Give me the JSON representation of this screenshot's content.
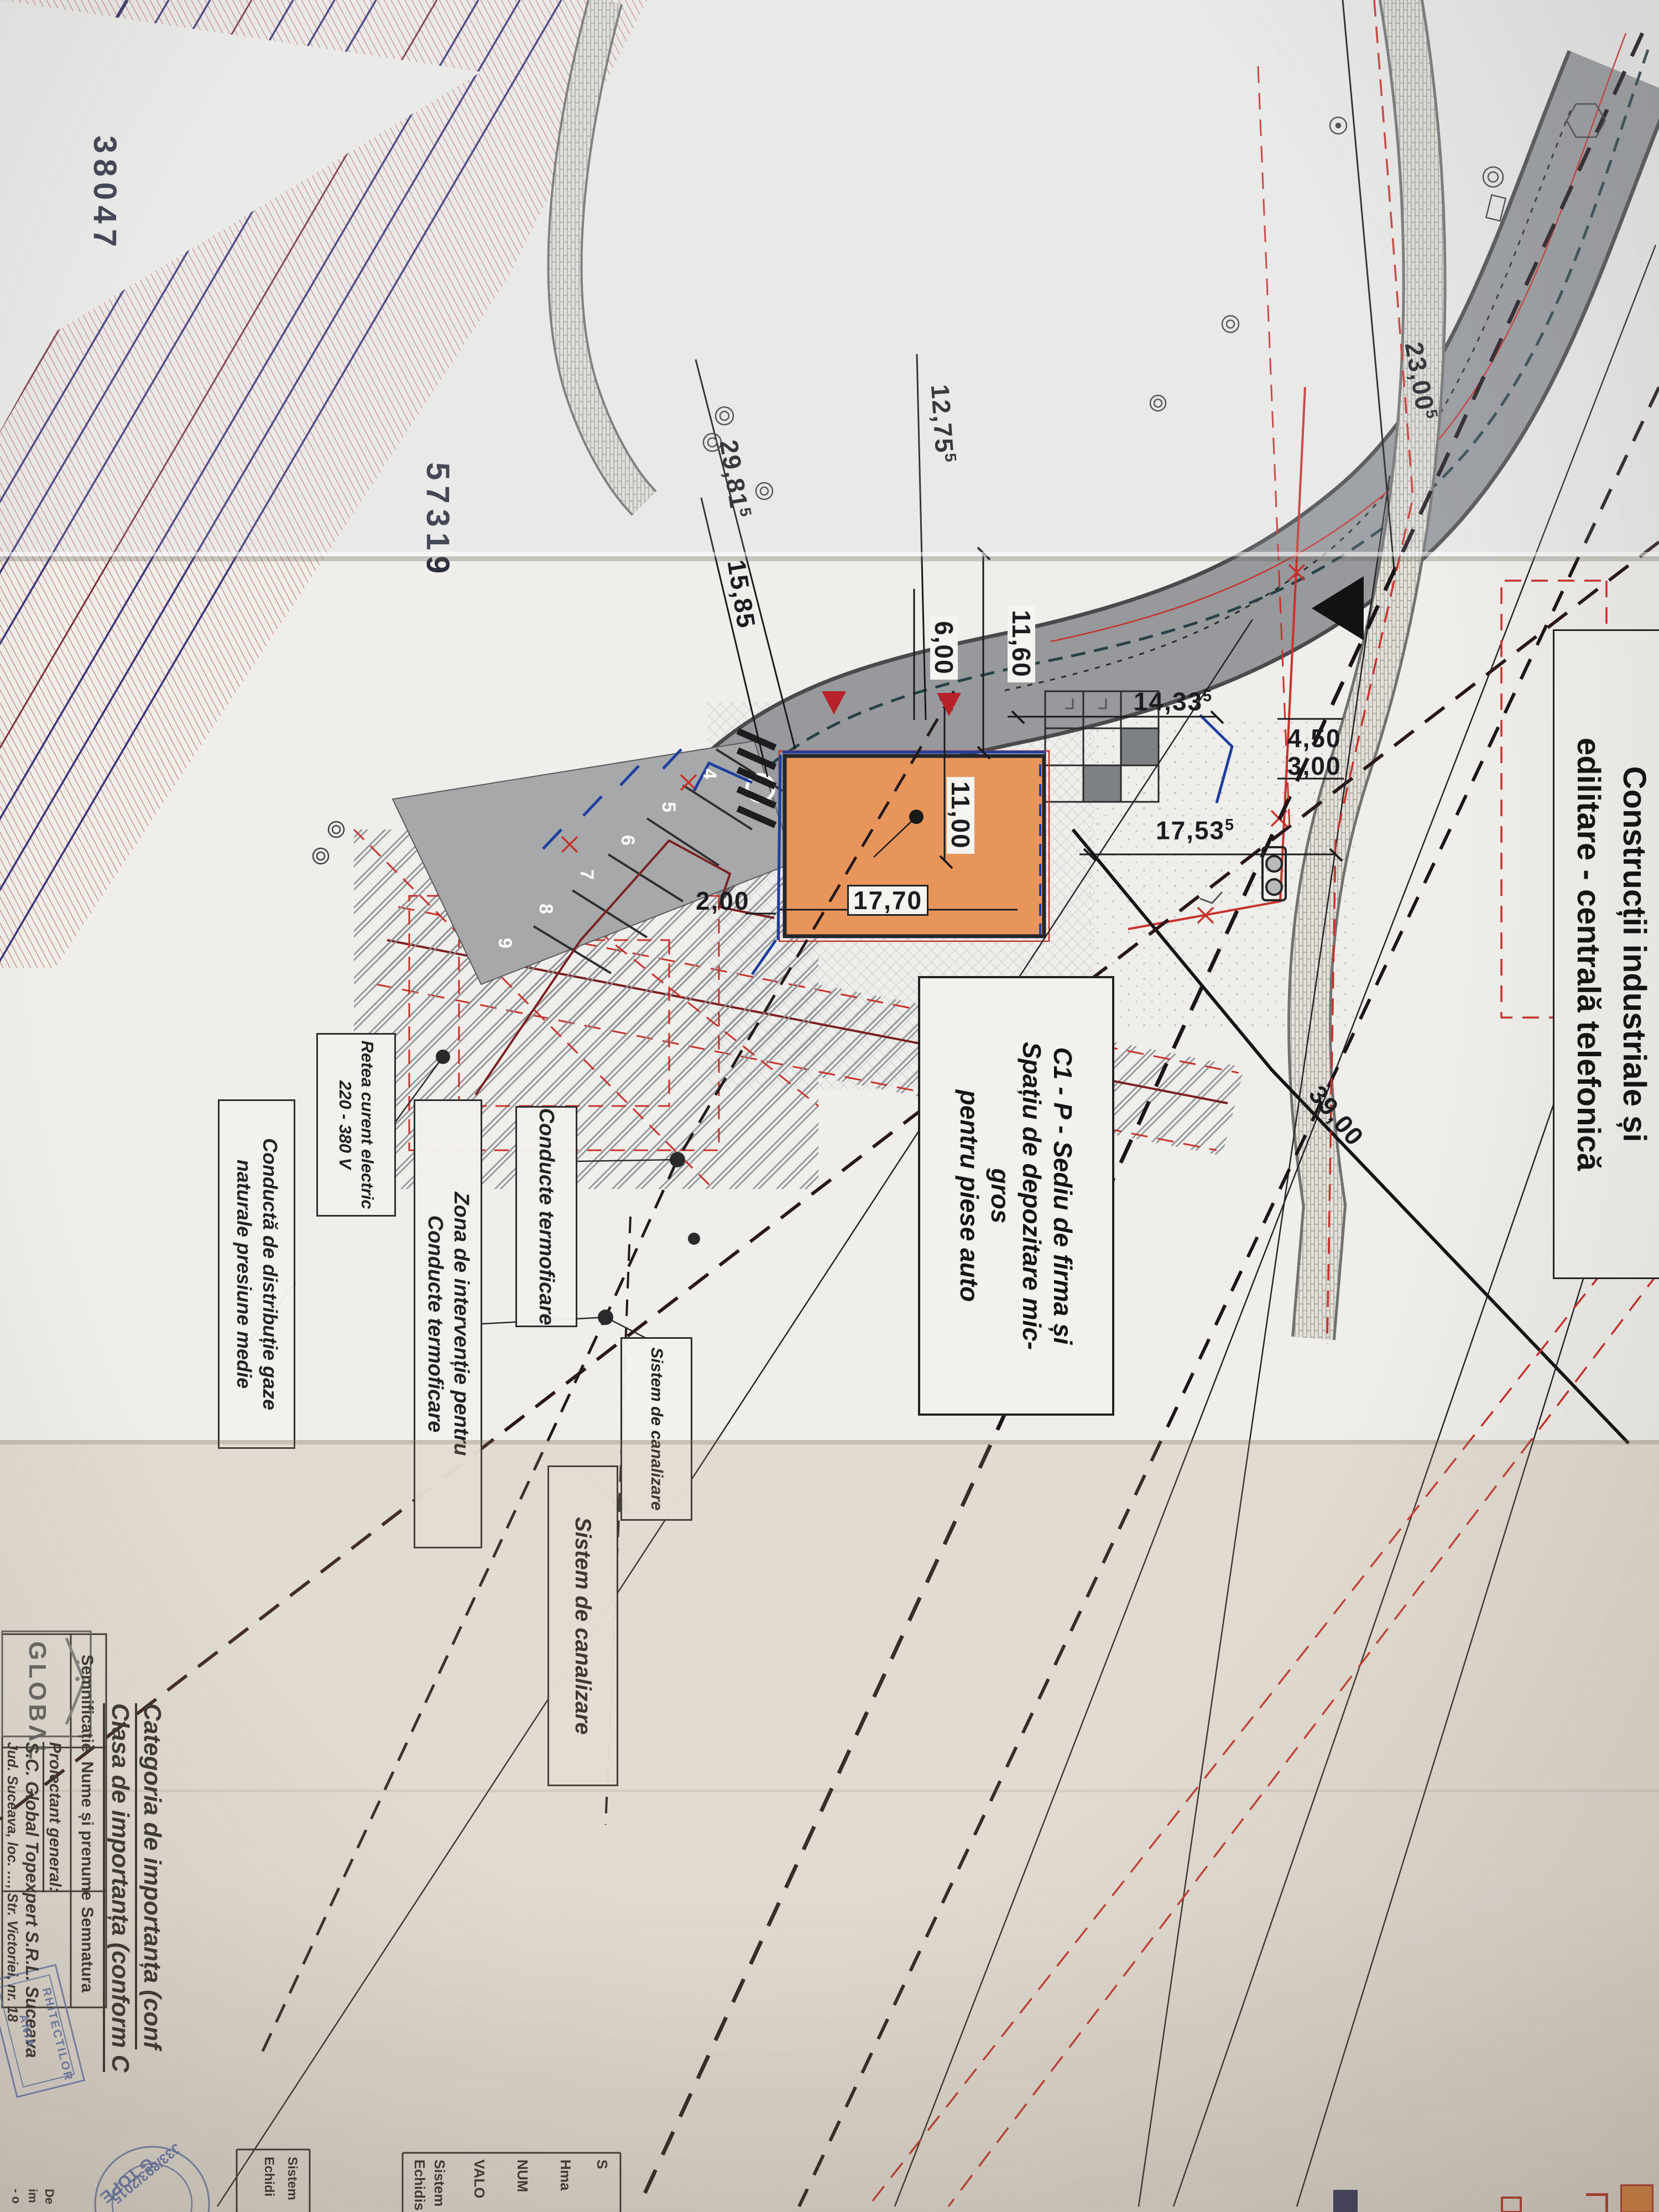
{
  "plan": {
    "coordinates": {
      "x_label": "38047",
      "y_label": "57319"
    },
    "top_building_label": {
      "line1": "Construcții industriale și",
      "line2": "edilitare - centrală telefonică"
    },
    "building_label": {
      "line1": "C1 - P - Sediu de firma și",
      "line2": "Spațiu de depozitare mic-",
      "line3": "gros",
      "line4": "pentru piese auto"
    },
    "dimensions": {
      "d23_00_5": {
        "value": "23,00",
        "sup": "5"
      },
      "d12_75_5": {
        "value": "12,75",
        "sup": "5"
      },
      "d29_81_5": {
        "value": "29,81",
        "sup": "5"
      },
      "d15_85": {
        "value": "15,85"
      },
      "d11_60": {
        "value": "11,60"
      },
      "d6_00": {
        "value": "6,00"
      },
      "d14_33_5": {
        "value": "14,33",
        "sup": "5"
      },
      "d4_50": {
        "value": "4,50"
      },
      "d3_00": {
        "value": "3,00"
      },
      "d17_53_5": {
        "value": "17,53",
        "sup": "5"
      },
      "d11_00": {
        "value": "11,00"
      },
      "d17_70": {
        "value": "17,70"
      },
      "d2_00_a": {
        "value": "2,00"
      },
      "d2_00_b": {
        "value": "2,00"
      },
      "d39_00": {
        "value": "39,00"
      }
    },
    "parking_stalls": [
      "4",
      "5",
      "6",
      "7",
      "8",
      "9"
    ],
    "callouts": {
      "termoficare": {
        "line1": "Conducte termoficare"
      },
      "zona": {
        "line1": "Zona de intervenție pentru",
        "line2": "Conducte termoficare"
      },
      "retea": {
        "line1": "Retea curent electric",
        "line2": "220 - 380 V"
      },
      "gaze": {
        "line1": "Conductă de distribuție gaze",
        "line2": "naturale presiune medie"
      },
      "canalizare1": {
        "line1": "Sistem de canalizare"
      },
      "canalizare2": {
        "line1": "Sistem de canalizare"
      }
    }
  },
  "title_block": {
    "logo_text": "GLOBΛL",
    "categoria_line": "Categoria de importanța (conf",
    "clasa_line": "Clasa de importanța (conform C",
    "table": {
      "col1": "Semnificație",
      "col2": "Nume și prenume",
      "col3": "Semnatura"
    },
    "proiectant": {
      "label": "Proiectant general:",
      "name": "S.C. Global Topexpert S.R.L. Suceava",
      "address": "Jud. Suceava, loc. …, Str. Victoriei, nr. 18"
    },
    "notes_box_a": [
      "S",
      "Hma",
      "NUM",
      "VALO",
      "Sistem",
      "Echidis"
    ],
    "notes_box_b": [
      "Sistem",
      "Echidi"
    ],
    "corner_fragments": [
      "De",
      "im",
      "- o"
    ],
    "stamps": {
      "round_line1": "J33/893/2015",
      "round_line2": "TOPE",
      "round_line3": "G",
      "square_line1": "RHITECTILOR",
      "square_line2": "ANIA"
    }
  },
  "colors": {
    "paper": "#f0efeb",
    "building_orange": "#e8955c",
    "boundary_red": "#c9312b",
    "hatch_red": "#b5433c",
    "railway_navy": "#3b3478",
    "railway_maroon": "#77303a",
    "road_gray": "#97999c",
    "parking_gray": "#a6a8aa",
    "pipe_blue": "#1f3f9e",
    "fence_maroon": "#7a2020",
    "stamp_blue": "#5672b8",
    "legend_orange": "#e8883d"
  }
}
